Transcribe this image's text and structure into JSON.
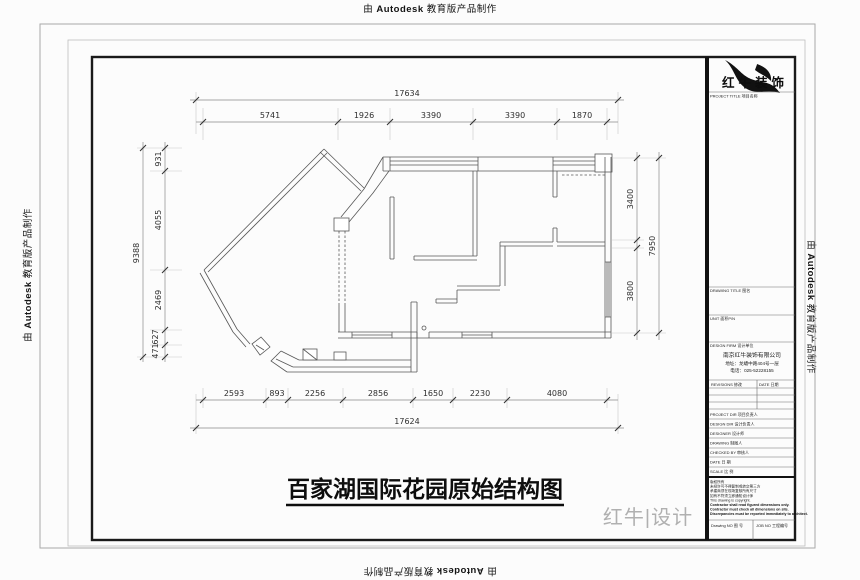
{
  "watermark": {
    "prefix": "由",
    "brand": "Autodesk",
    "suffix": "教育版产品制作"
  },
  "plan": {
    "title": "百家湖国际花园原始结构图",
    "brand_signature": "红牛|设计",
    "dimensions": {
      "top": {
        "total": "17634",
        "segments": [
          "5741",
          "1926",
          "3390",
          "3390",
          "1870"
        ]
      },
      "bottom": {
        "total": "17624",
        "segments": [
          "2593",
          "893",
          "2256",
          "2856",
          "1650",
          "2230",
          "4080"
        ]
      },
      "left": {
        "total": "9388",
        "segments": [
          "931",
          "4055",
          "2469",
          "627",
          "471"
        ]
      },
      "right": {
        "total": "7950",
        "segments": [
          "3400",
          "3800"
        ]
      }
    }
  },
  "title_block": {
    "brand_name": "红牛装饰",
    "labels": {
      "project_title": "PROJECT TITLE 项目名称",
      "drawing_title": "DRAWING TITLE 图名",
      "unit": "UNIT 面积P/N",
      "design_firm": "DESIGN FIRM 设计单位",
      "revisions": "REVISIONS 修改",
      "date_col": "DATE 日期",
      "drawing_no": "Drawing NO 图 号",
      "job_no": "JOB NO 工程编号"
    },
    "company": {
      "name": "南京红牛装饰有限公司",
      "address": "地址：龙蟠中路404号一层",
      "phone": "电话：025-52228155"
    },
    "personnel_rows": [
      "PROJECT DIR 项目负责人",
      "DESIGN DIR 设计负责人",
      "DESIGNER 设计师",
      "DRAWING 制图人",
      "CHECKED BY 审核人",
      "DATE 日 期",
      "SCALE 比 例"
    ],
    "notes": [
      "版权所有",
      "未经许可不得复制或转交第三方",
      "承建商须在现场复核所有尺寸",
      "如有不符须立即通知设计师",
      "This drawing is copyright.",
      "Contractor shall read figured dimensions only.",
      "Contractor must check all dimensions on site.",
      "Discrepancies must be reported immediately to architect."
    ]
  }
}
